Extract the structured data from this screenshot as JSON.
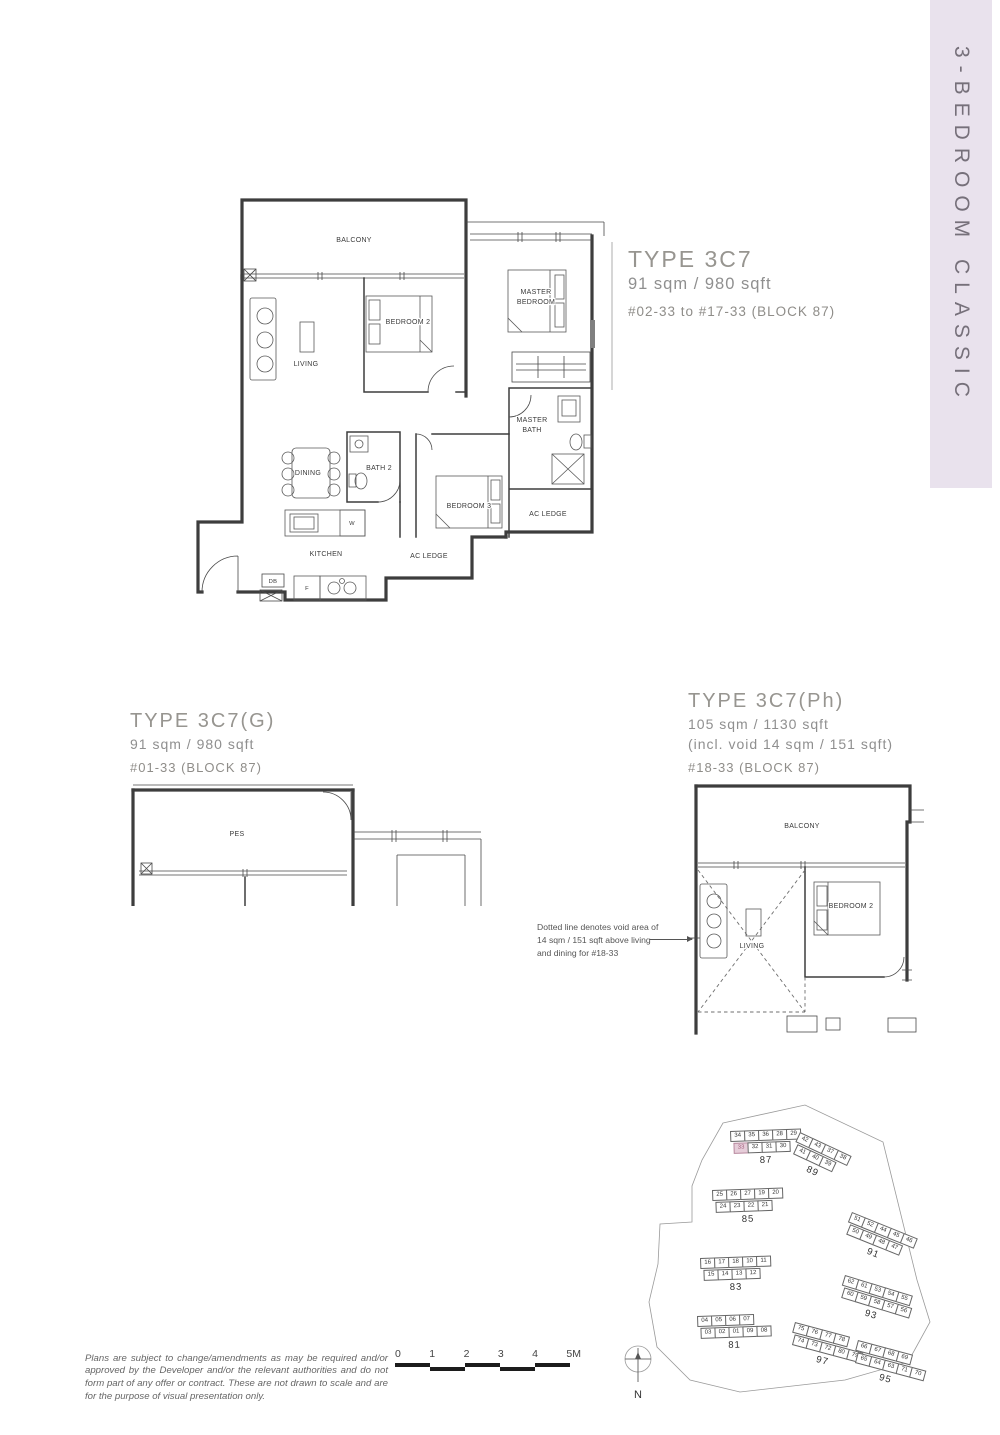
{
  "banner": {
    "label": "3-BEDROOM CLASSIC",
    "bg_color": "#e9e2ed",
    "text_color": "#76707a"
  },
  "unit_main": {
    "title": "TYPE 3C7",
    "area": "91 sqm / 980 sqft",
    "levels": "#02-33 to #17-33 (BLOCK 87)",
    "rooms": {
      "balcony": "BALCONY",
      "living": "LIVING",
      "bedroom2": "BEDROOM 2",
      "master_bedroom_l1": "MASTER",
      "master_bedroom_l2": "BEDROOM",
      "master_bath_l1": "MASTER",
      "master_bath_l2": "BATH",
      "bath2": "BATH 2",
      "dining": "DINING",
      "bedroom3": "BEDROOM 3",
      "ac_ledge_right": "AC LEDGE",
      "ac_ledge_mid": "AC LEDGE",
      "kitchen": "KITCHEN",
      "db": "DB",
      "fridge": "F",
      "washer": "W"
    }
  },
  "unit_g": {
    "title": "TYPE 3C7(G)",
    "area": "91 sqm / 980 sqft",
    "levels": "#01-33 (BLOCK 87)",
    "rooms": {
      "pes": "PES"
    }
  },
  "unit_ph": {
    "title": "TYPE 3C7(Ph)",
    "area": "105 sqm / 1130 sqft",
    "area_note": "(incl. void 14 sqm / 151 sqft)",
    "levels": "#18-33 (BLOCK 87)",
    "rooms": {
      "balcony": "BALCONY",
      "living": "LIVING",
      "bedroom2": "BEDROOM 2"
    },
    "void_note_l1": "Dotted line denotes void area of",
    "void_note_l2": "14 sqm / 151 sqft  above living",
    "void_note_l3": "and dining for #18-33"
  },
  "site_plan": {
    "highlight_color": "#e6cdd9",
    "highlighted_stack": "33",
    "blocks": [
      {
        "label": "87",
        "x": 730,
        "y": 1131,
        "rot": -2,
        "rows": [
          [
            "34",
            "35",
            "36",
            "28",
            "29"
          ],
          [
            "33",
            "32",
            "31",
            "30"
          ]
        ],
        "hl": [
          1,
          0
        ]
      },
      {
        "label": "89",
        "x": 800,
        "y": 1132,
        "rot": 25,
        "rows": [
          [
            "42",
            "43",
            "37",
            "38"
          ],
          [
            "41",
            "40",
            "39"
          ]
        ]
      },
      {
        "label": "85",
        "x": 712,
        "y": 1190,
        "rot": -2,
        "rows": [
          [
            "25",
            "26",
            "27",
            "19",
            "20"
          ],
          [
            "24",
            "23",
            "22",
            "21"
          ]
        ]
      },
      {
        "label": "83",
        "x": 700,
        "y": 1258,
        "rot": -2,
        "rows": [
          [
            "16",
            "17",
            "18",
            "10",
            "11"
          ],
          [
            "15",
            "14",
            "13",
            "12"
          ]
        ]
      },
      {
        "label": "81",
        "x": 697,
        "y": 1316,
        "rot": -2,
        "rows": [
          [
            "04",
            "05",
            "06",
            "07"
          ],
          [
            "03",
            "02",
            "01",
            "09",
            "08"
          ]
        ]
      },
      {
        "label": "91",
        "x": 852,
        "y": 1212,
        "rot": 22,
        "rows": [
          [
            "51",
            "52",
            "44",
            "45",
            "46"
          ],
          [
            "50",
            "49",
            "48",
            "47"
          ]
        ]
      },
      {
        "label": "93",
        "x": 845,
        "y": 1275,
        "rot": 17,
        "rows": [
          [
            "62",
            "61",
            "53",
            "54",
            "55"
          ],
          [
            "60",
            "59",
            "58",
            "57",
            "56"
          ]
        ]
      },
      {
        "label": "97",
        "x": 795,
        "y": 1322,
        "rot": 15,
        "rows": [
          [
            "75",
            "76",
            "77",
            "78"
          ],
          [
            "74",
            "73",
            "72",
            "80",
            "79"
          ]
        ]
      },
      {
        "label": "95",
        "x": 858,
        "y": 1340,
        "rot": 15,
        "rows": [
          [
            "66",
            "67",
            "68",
            "69"
          ],
          [
            "65",
            "64",
            "63",
            "71",
            "70"
          ]
        ]
      }
    ]
  },
  "scale_bar": {
    "ticks": [
      "0",
      "1",
      "2",
      "3",
      "4",
      "5M"
    ]
  },
  "compass": {
    "label": "N"
  },
  "disclaimer": "Plans are subject to change/amendments as may be required and/or approved by the Developer and/or the relevant authorities and do not form part of any offer or contract. These are not drawn to scale and are for the purpose of visual presentation only."
}
